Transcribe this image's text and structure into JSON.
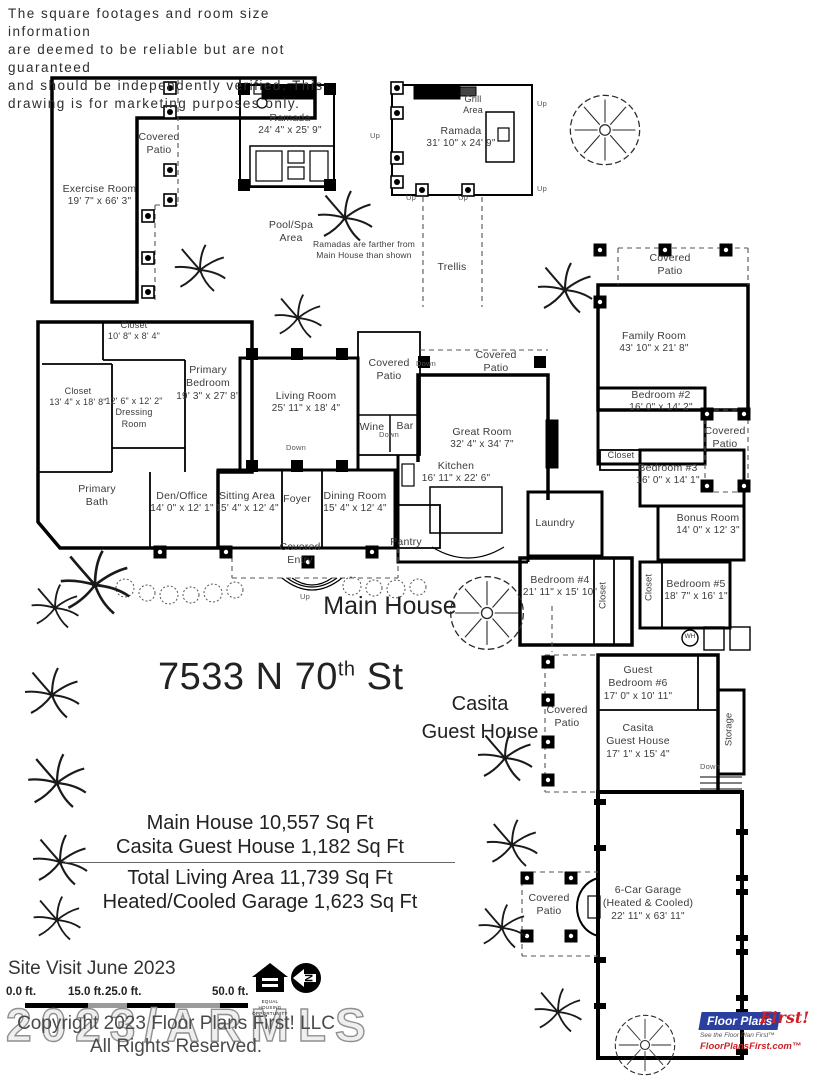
{
  "disclaimer": {
    "lines": [
      "The square footages and room size information",
      "are deemed to be reliable but are not guaranteed",
      "and should be independently verified. This",
      "drawing is for marketing purposes only."
    ]
  },
  "labels": {
    "covered": "Covered",
    "patio": "Patio",
    "entry": "Entry",
    "closet": "Closet",
    "storage": "Storage",
    "grill_1": "Grill",
    "grill_2": "Area",
    "pool_1": "Pool/Spa",
    "pool_2": "Area",
    "note_1": "Ramadas are farther from",
    "note_2": "Main House than shown",
    "trellis": "Trellis",
    "dressing_1": "Dressing",
    "dressing_2": "Room",
    "pbath_1": "Primary",
    "pbath_2": "Bath",
    "primary_1": "Primary",
    "primary_2": "Bedroom",
    "guest_1": "Guest",
    "guest_2": "Bedroom #6",
    "casita_1": "Casita",
    "casita_2": "Guest House",
    "foyer": "Foyer",
    "pantry": "Pantry",
    "laundry": "Laundry",
    "wine": "Wine",
    "bar": "Bar",
    "main_house": "Main House",
    "address_num": "7533 N 70",
    "address_sup": "th",
    "address_tail": " St"
  },
  "rooms": {
    "ramada1": {
      "name": "Ramada",
      "dims": "24' 4\" x 25' 9\""
    },
    "ramada2": {
      "name": "Ramada",
      "dims": "31' 10\" x 24' 9\""
    },
    "exercise": {
      "name": "Exercise Room",
      "dims": "19' 7\" x 66' 3\""
    },
    "family": {
      "name": "Family Room",
      "dims": "43' 10\" x 21' 8\""
    },
    "closet_a": {
      "dims": "10' 8\" x 8' 4\""
    },
    "primary_bedroom": {
      "dims": "19' 3\" x 27' 8\""
    },
    "closet_b": {
      "dims": "13' 4\" x 18' 8\""
    },
    "dressing": {
      "dims": "12' 6\" x 12' 2\""
    },
    "living": {
      "name": "Living Room",
      "dims": "25' 11\" x 18' 4\""
    },
    "great": {
      "name": "Great Room",
      "dims": "32' 4\" x 34' 7\""
    },
    "kitchen": {
      "name": "Kitchen",
      "dims": "16' 11\" x 22' 6\""
    },
    "bedroom2": {
      "name": "Bedroom #2",
      "dims": "16' 0\" x 14' 2\""
    },
    "bedroom3": {
      "name": "Bedroom #3",
      "dims": "16' 0\" x 14' 1\""
    },
    "bedroom4": {
      "name": "Bedroom #4",
      "dims": "21' 11\" x 15' 10\""
    },
    "bedroom5": {
      "name": "Bedroom #5",
      "dims": "18' 7\" x 16' 1\""
    },
    "bonus": {
      "name": "Bonus Room",
      "dims": "14' 0\" x 12' 3\""
    },
    "den": {
      "name": "Den/Office",
      "dims": "14' 0\" x 12' 1\""
    },
    "sitting": {
      "name": "Sitting Area",
      "dims": "15' 4\" x 12' 4\""
    },
    "dining": {
      "name": "Dining Room",
      "dims": "15' 4\" x 12' 4\""
    },
    "guest6": {
      "dims": "17' 0\" x 10' 11\""
    },
    "casita": {
      "dims": "17' 1\" x 15' 4\""
    },
    "garage": {
      "name": "6-Car Garage",
      "sub": "(Heated & Cooled)",
      "dims": "22' 11\" x 63' 11\""
    }
  },
  "summary": {
    "line1": "Main House 10,557 Sq Ft",
    "line2": "Casita Guest House 1,182 Sq Ft",
    "line3": "Total Living Area 11,739 Sq Ft",
    "line4": "Heated/Cooled Garage 1,623 Sq Ft"
  },
  "footer": {
    "site_visit": "Site Visit June 2023",
    "scale_labels": [
      "0.0 ft.",
      "15.0 ft.",
      "25.0 ft.",
      "50.0 ft."
    ],
    "copyright_1": "Copyright 2023 Floor Plans First! LLC",
    "copyright_2": "All Rights Reserved.",
    "watermark": "2023/ARMLS"
  },
  "logo": {
    "name_1": "Floor Plans",
    "name_2": "First!",
    "tagline": "See the Floor Plan First™",
    "url": "FloorPlansFirst.com™",
    "eho_1": "EQUAL",
    "eho_2": "HOUSING",
    "eho_3": "OPPORTUNITY",
    "north": "N"
  },
  "annotations": {
    "up": "Up",
    "down": "Down",
    "wh": "WH"
  },
  "colors": {
    "wall": "#000000",
    "label": "#3b3b3b",
    "logo_blue": "#2b3f9e",
    "logo_red": "#cc2127"
  }
}
